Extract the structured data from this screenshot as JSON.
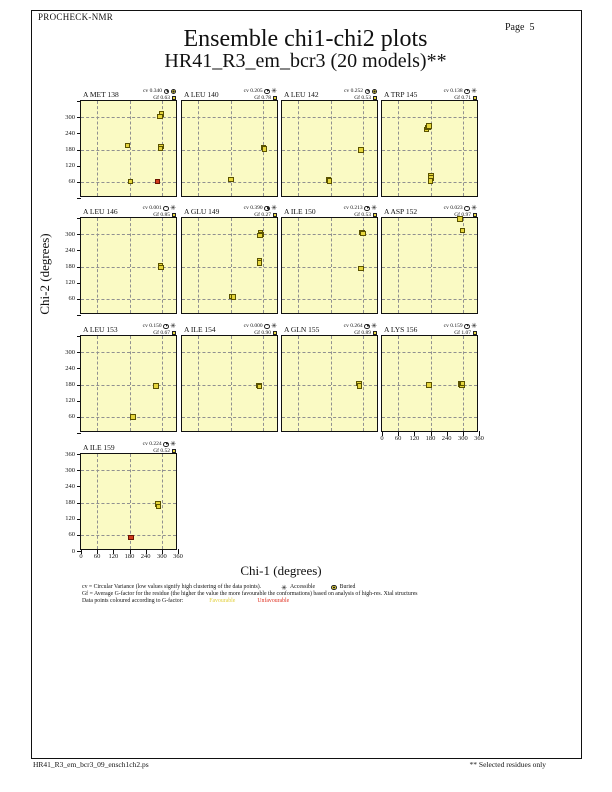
{
  "page_header": {
    "app_name": "PROCHECK-NMR",
    "page_label": "Page  5"
  },
  "title": "Ensemble chi1-chi2 plots",
  "subtitle": "HR41_R3_em_bcr3 (20 models)**",
  "axis": {
    "x_label": "Chi-1 (degrees)",
    "y_label": "Chi-2 (degrees)",
    "tick_values": [
      0,
      60,
      120,
      180,
      240,
      300,
      360
    ],
    "grid_values": [
      60,
      180,
      300
    ],
    "range": [
      0,
      360
    ]
  },
  "plot_labels": {
    "cv_prefix": "cv",
    "gf_prefix": "Gf"
  },
  "icons": {
    "accessible_char": "✳",
    "pie": "circular-variance-pie-icon",
    "buried": "buried-circle-icon",
    "gf_marker": "gf-square-icon"
  },
  "colors": {
    "plot_bg": "#FAFAC4",
    "favourable": "#E6D63C",
    "unfavourable": "#D23A1E",
    "mid": "#E08A28",
    "marker_border": "#5A5200",
    "marker_border_red": "#6B1500",
    "grid": "#909090",
    "frame": "#111111",
    "legend_favourable_text": "#E2CF3A",
    "legend_unfavourable_text": "#E03020"
  },
  "chart_data": {
    "type": "scatter",
    "x_range": [
      0,
      360
    ],
    "y_range": [
      0,
      360
    ],
    "plots": [
      {
        "residue": "A MET 138",
        "cv": "0.340",
        "gf": "0.63",
        "surface": "Buried",
        "row": 0,
        "col": 0,
        "x_axis_labels": false,
        "points": [
          {
            "chi1": 299,
            "chi2": 311,
            "g": "favourable"
          },
          {
            "chi1": 294,
            "chi2": 302,
            "g": "favourable"
          },
          {
            "chi1": 172,
            "chi2": 194,
            "g": "favourable"
          },
          {
            "chi1": 296,
            "chi2": 192,
            "g": "favourable"
          },
          {
            "chi1": 295,
            "chi2": 183,
            "g": "favourable"
          },
          {
            "chi1": 184,
            "chi2": 62,
            "g": "favourable"
          },
          {
            "chi1": 283,
            "chi2": 62,
            "g": "unfavourable"
          }
        ]
      },
      {
        "residue": "A LEU 140",
        "cv": "0.205",
        "gf": "0.78",
        "surface": "Accessible",
        "row": 0,
        "col": 1,
        "x_axis_labels": false,
        "points": [
          {
            "chi1": 181,
            "chi2": 68,
            "g": "favourable"
          },
          {
            "chi1": 303,
            "chi2": 187,
            "g": "favourable"
          },
          {
            "chi1": 306,
            "chi2": 181,
            "g": "favourable"
          }
        ]
      },
      {
        "residue": "A LEU 142",
        "cv": "0.252",
        "gf": "0.53",
        "surface": "Buried",
        "row": 0,
        "col": 2,
        "x_axis_labels": false,
        "points": [
          {
            "chi1": 293,
            "chi2": 179,
            "g": "favourable"
          },
          {
            "chi1": 172,
            "chi2": 67,
            "g": "favourable"
          },
          {
            "chi1": 177,
            "chi2": 64,
            "g": "favourable"
          }
        ]
      },
      {
        "residue": "A TRP 145",
        "cv": "0.138",
        "gf": "0.71",
        "surface": "Accessible",
        "row": 0,
        "col": 3,
        "x_axis_labels": false,
        "points": [
          {
            "chi1": 166,
            "chi2": 254,
            "g": "favourable"
          },
          {
            "chi1": 170,
            "chi2": 261,
            "g": "favourable"
          },
          {
            "chi1": 174,
            "chi2": 268,
            "g": "favourable"
          },
          {
            "chi1": 181,
            "chi2": 84,
            "g": "favourable"
          },
          {
            "chi1": 182,
            "chi2": 74,
            "g": "favourable"
          },
          {
            "chi1": 180,
            "chi2": 64,
            "g": "favourable"
          }
        ]
      },
      {
        "residue": "A LEU 146",
        "cv": "0.001",
        "gf": "0.85",
        "surface": "Accessible",
        "row": 1,
        "col": 0,
        "x_axis_labels": false,
        "points": [
          {
            "chi1": 295,
            "chi2": 181,
            "g": "favourable"
          },
          {
            "chi1": 297,
            "chi2": 176,
            "g": "favourable"
          }
        ]
      },
      {
        "residue": "A GLU 149",
        "cv": "0.390",
        "gf": "0.27",
        "surface": "Accessible",
        "row": 1,
        "col": 1,
        "x_axis_labels": false,
        "points": [
          {
            "chi1": 291,
            "chi2": 306,
            "g": "favourable"
          },
          {
            "chi1": 293,
            "chi2": 299,
            "g": "favourable"
          },
          {
            "chi1": 289,
            "chi2": 295,
            "g": "favourable"
          },
          {
            "chi1": 287,
            "chi2": 203,
            "g": "favourable"
          },
          {
            "chi1": 288,
            "chi2": 193,
            "g": "favourable"
          },
          {
            "chi1": 186,
            "chi2": 68,
            "g": "favourable"
          },
          {
            "chi1": 191,
            "chi2": 66,
            "g": "favourable"
          }
        ]
      },
      {
        "residue": "A ILE 150",
        "cv": "0.213",
        "gf": "0.53",
        "surface": "Accessible",
        "row": 1,
        "col": 2,
        "x_axis_labels": false,
        "points": [
          {
            "chi1": 297,
            "chi2": 307,
            "g": "mid"
          },
          {
            "chi1": 300,
            "chi2": 302,
            "g": "favourable"
          },
          {
            "chi1": 294,
            "chi2": 173,
            "g": "favourable"
          }
        ]
      },
      {
        "residue": "A ASP 152",
        "cv": "0.023",
        "gf": "0.97",
        "surface": "Accessible",
        "row": 1,
        "col": 3,
        "x_axis_labels": false,
        "points": [
          {
            "chi1": 289,
            "chi2": 357,
            "g": "favourable"
          },
          {
            "chi1": 298,
            "chi2": 313,
            "g": "favourable"
          }
        ]
      },
      {
        "residue": "A LEU 153",
        "cv": "0.150",
        "gf": "0.67",
        "surface": "Accessible",
        "row": 2,
        "col": 0,
        "x_axis_labels": false,
        "points": [
          {
            "chi1": 278,
            "chi2": 174,
            "g": "favourable"
          },
          {
            "chi1": 193,
            "chi2": 59,
            "g": "favourable"
          }
        ]
      },
      {
        "residue": "A ILE 154",
        "cv": "0.000",
        "gf": "0.90",
        "surface": "Accessible",
        "row": 2,
        "col": 1,
        "x_axis_labels": false,
        "points": [
          {
            "chi1": 286,
            "chi2": 176,
            "g": "favourable"
          },
          {
            "chi1": 287,
            "chi2": 173,
            "g": "favourable"
          }
        ]
      },
      {
        "residue": "A GLN 155",
        "cv": "0.264",
        "gf": "0.89",
        "surface": "Accessible",
        "row": 2,
        "col": 2,
        "x_axis_labels": false,
        "points": [
          {
            "chi1": 286,
            "chi2": 183,
            "g": "favourable"
          },
          {
            "chi1": 287,
            "chi2": 174,
            "g": "favourable"
          }
        ]
      },
      {
        "residue": "A LYS 156",
        "cv": "0.159",
        "gf": "1.07",
        "surface": "Accessible",
        "row": 2,
        "col": 3,
        "x_axis_labels": true,
        "points": [
          {
            "chi1": 174,
            "chi2": 178,
            "g": "favourable"
          },
          {
            "chi1": 291,
            "chi2": 181,
            "g": "favourable"
          },
          {
            "chi1": 296,
            "chi2": 179,
            "g": "favourable"
          },
          {
            "chi1": 299,
            "chi2": 184,
            "g": "favourable"
          }
        ]
      },
      {
        "residue": "A ILE 159",
        "cv": "0.224",
        "gf": "0.52",
        "surface": "Accessible",
        "row": 3,
        "col": 0,
        "x_axis_labels": true,
        "points": [
          {
            "chi1": 286,
            "chi2": 175,
            "g": "favourable"
          },
          {
            "chi1": 287,
            "chi2": 166,
            "g": "favourable"
          },
          {
            "chi1": 186,
            "chi2": 50,
            "g": "unfavourable"
          }
        ]
      }
    ]
  },
  "legend": {
    "line1_text": "cv = Circular Variance (low values signify high clustering of the data points).",
    "accessible_label": "Accessible",
    "buried_label": "Buried",
    "line2_text": "Gf = Average G-factor for the residue (the higher the value the more favourable the conformations) based on analysis of high-res. Xtal structures",
    "line3_text": "Data points coloured according to G-factor:",
    "favourable_label": "Favourable",
    "unfavourable_label": "Unfavourable"
  },
  "footer": {
    "left_text": "HR41_R3_em_bcr3_09_ensch1ch2.ps",
    "right_text": "** Selected residues only"
  }
}
